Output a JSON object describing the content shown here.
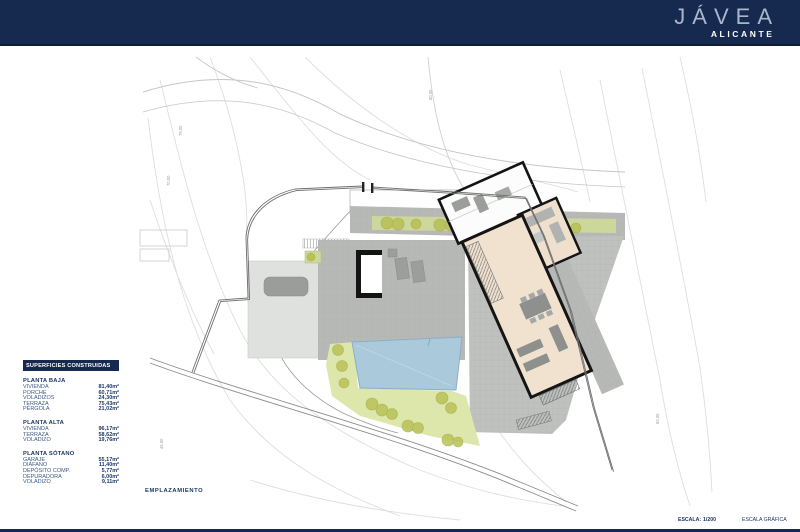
{
  "header": {
    "city": "JÁVEA",
    "province": "ALICANTE"
  },
  "areas_table": {
    "title": "SUPERFICIES CONSTRUIDAS",
    "sections": [
      {
        "name": "PLANTA BAJA",
        "rows": [
          {
            "label": "VIVIENDA",
            "value": "81,40m²"
          },
          {
            "label": "PORCHE",
            "value": "60,71m²"
          },
          {
            "label": "VOLADIZOS",
            "value": "24,30m²"
          },
          {
            "label": "TERRAZA",
            "value": "75,43m²"
          },
          {
            "label": "PÉRGOLA",
            "value": "21,02m²"
          }
        ]
      },
      {
        "name": "PLANTA ALTA",
        "rows": [
          {
            "label": "VIVIENDA",
            "value": "96,17m²"
          },
          {
            "label": "TERRAZA",
            "value": "58,62m²"
          },
          {
            "label": "VOLADIZO",
            "value": "19,76m²"
          }
        ]
      },
      {
        "name": "PLANTA SÓTANO",
        "rows": [
          {
            "label": "GARAJE",
            "value": "55,17m²"
          },
          {
            "label": "DIÁFANO",
            "value": "11,40m²"
          },
          {
            "label": "DEPÓSITO COMP.",
            "value": "5,77m²"
          },
          {
            "label": "DEPURADORA",
            "value": "6,00m²"
          },
          {
            "label": "VOLADIZO",
            "value": "9,11m²"
          }
        ]
      }
    ]
  },
  "plan": {
    "caption": "EMPLAZAMIENTO",
    "contour_labels": [
      "80.00",
      "75.00",
      "70.00",
      "60.00",
      "45.00"
    ]
  },
  "footer": {
    "scale_label": "ESCALA:",
    "scale_value": "1/200",
    "graphic_scale_label": "ESCALA GRÁFICA"
  },
  "colors": {
    "header_navy": "#16294e",
    "text_navy": "#1c3866",
    "terrace_gray": "#b7b9b6",
    "pool_blue": "#aac9db",
    "garden_green": "#dde7ab",
    "tree_olive": "#b9c257",
    "floor_beige": "#f1e2d0"
  }
}
